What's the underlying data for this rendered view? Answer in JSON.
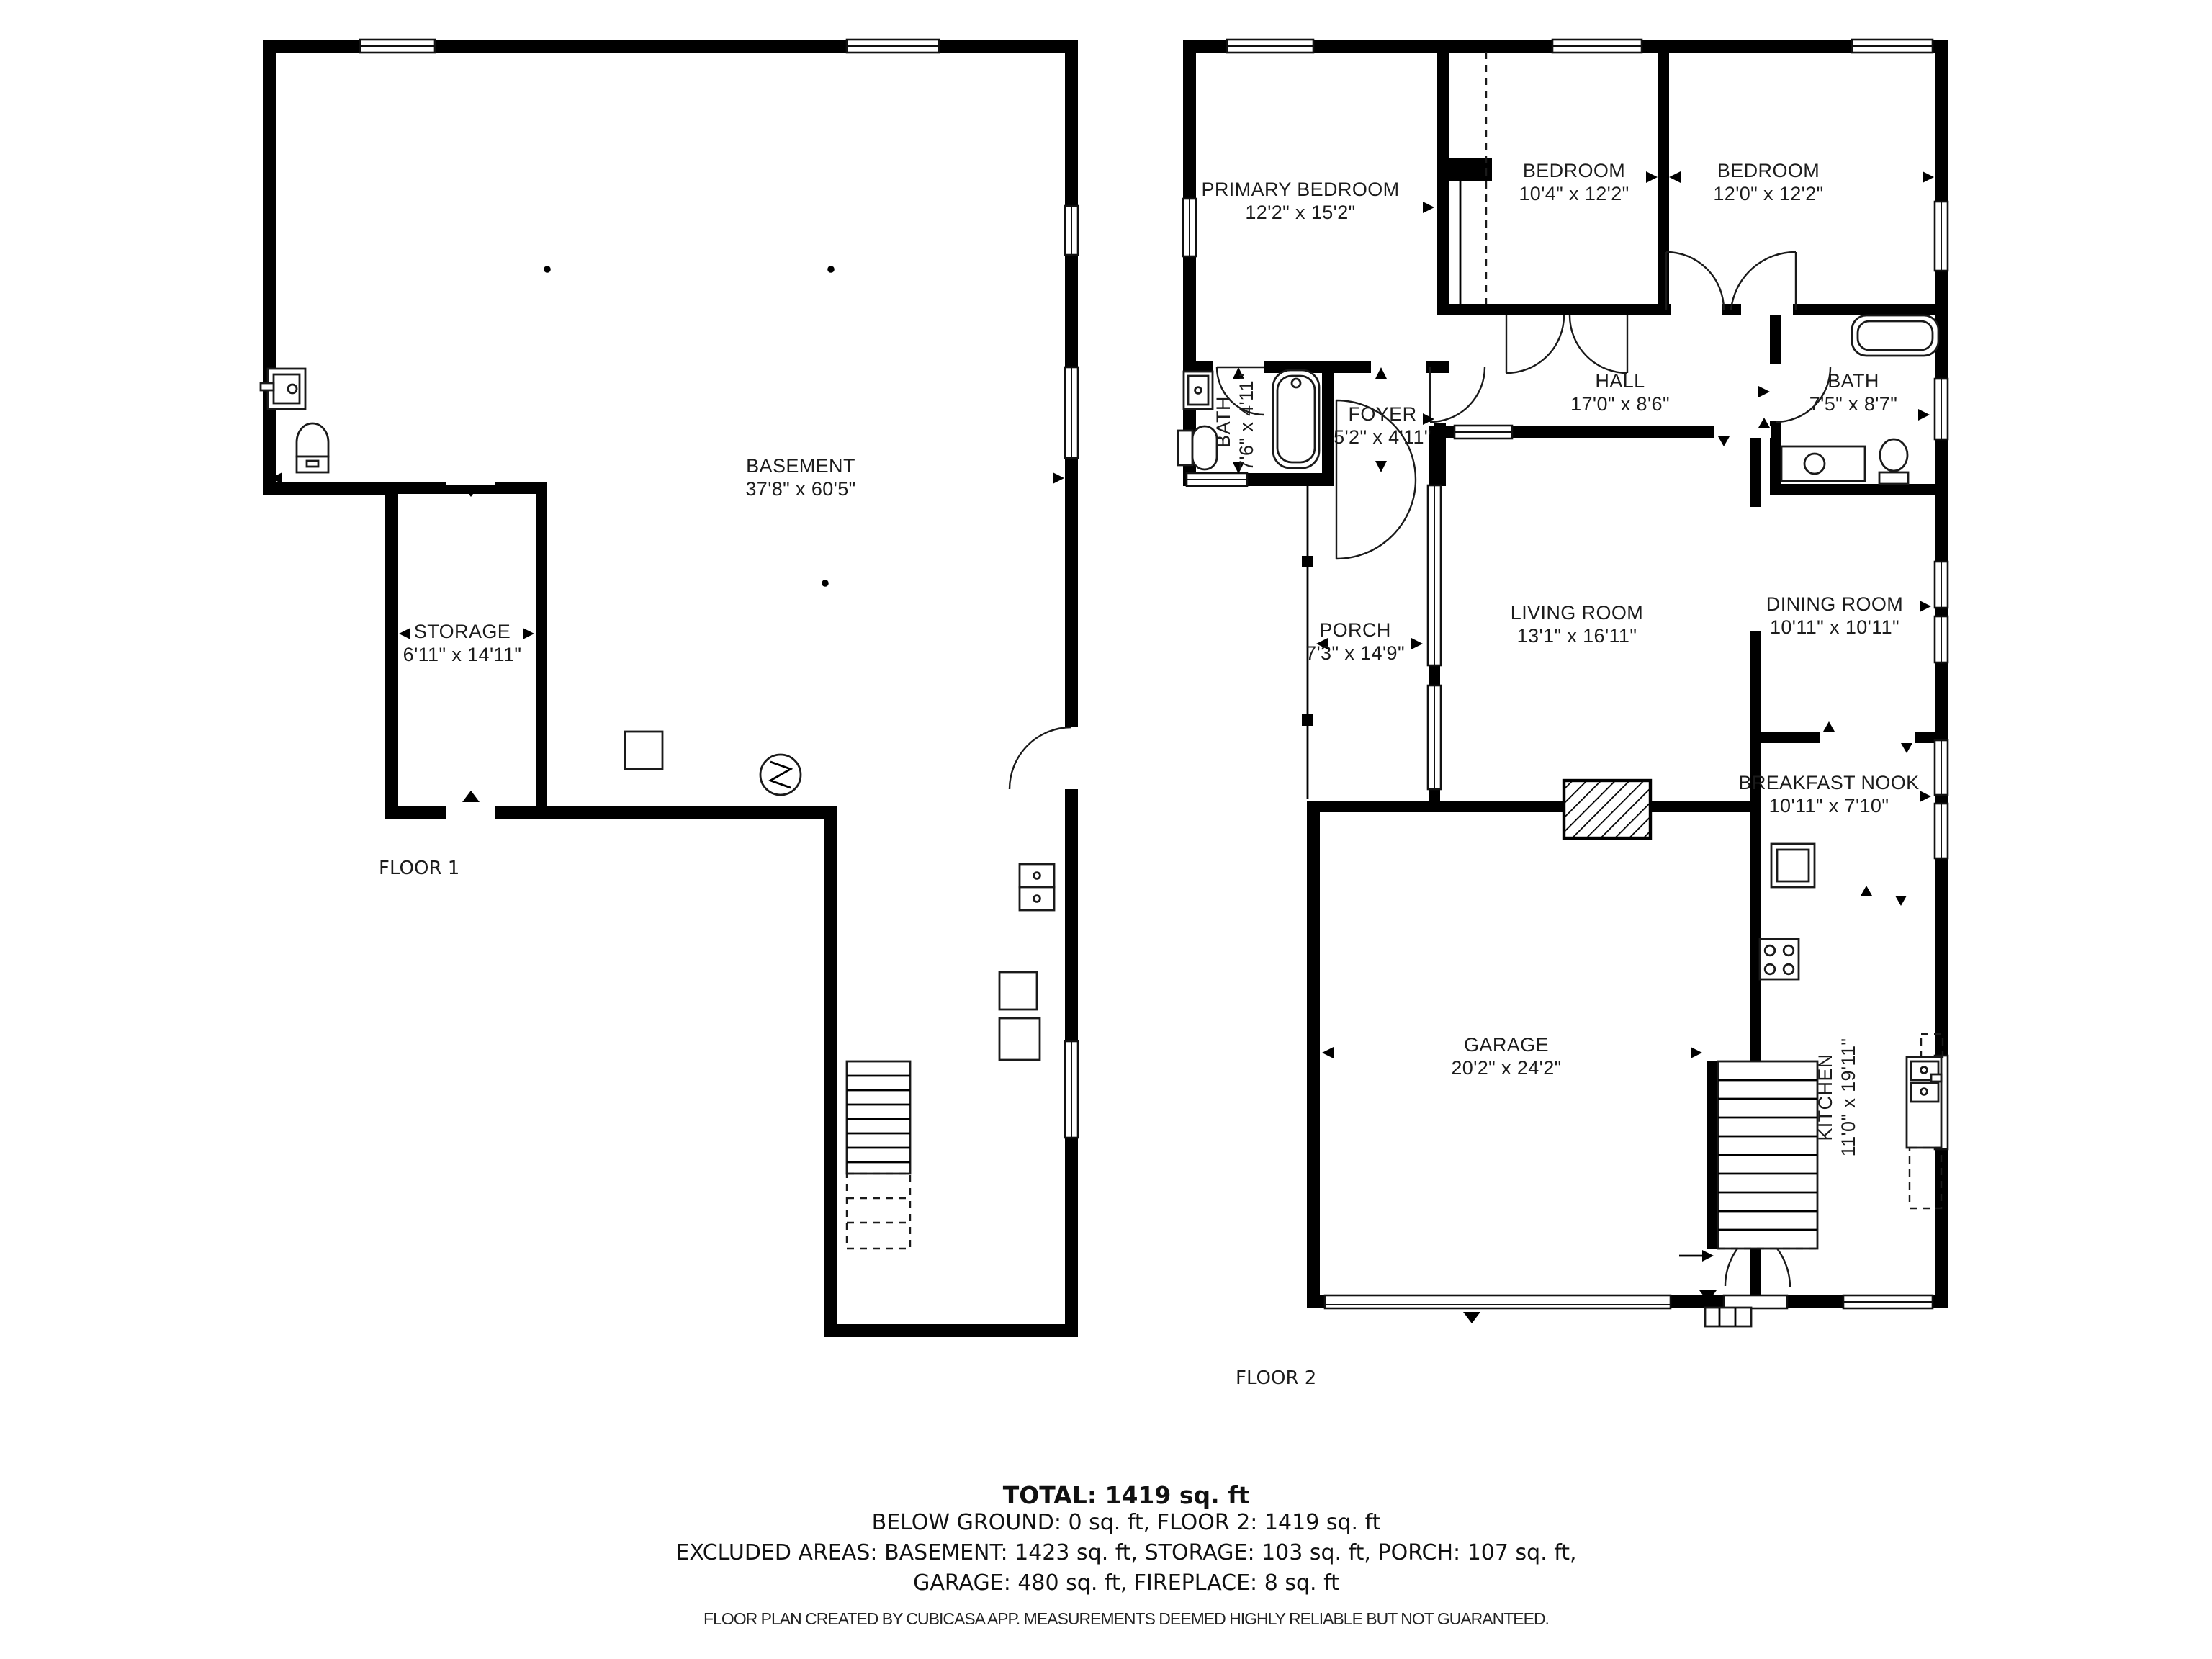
{
  "colors": {
    "wall": "#000000",
    "background": "#ffffff",
    "text": "#1c1c1c"
  },
  "floor1": {
    "label": "FLOOR 1",
    "rooms": [
      {
        "name": "BASEMENT",
        "dims": "37'8\" x 60'5\""
      },
      {
        "name": "STORAGE",
        "dims": "6'11\" x 14'11\""
      }
    ]
  },
  "floor2": {
    "label": "FLOOR 2",
    "rooms": [
      {
        "name": "PRIMARY BEDROOM",
        "dims": "12'2\" x 15'2\""
      },
      {
        "name": "BEDROOM",
        "dims": "10'4\" x 12'2\""
      },
      {
        "name": "BEDROOM",
        "dims": "12'0\" x 12'2\""
      },
      {
        "name": "HALL",
        "dims": "17'0\" x 8'6\""
      },
      {
        "name": "BATH",
        "dims": "7'6\" x 4'11\""
      },
      {
        "name": "FOYER",
        "dims": "5'2\" x 4'11\""
      },
      {
        "name": "BATH",
        "dims": "7'5\" x 8'7\""
      },
      {
        "name": "PORCH",
        "dims": "7'3\" x 14'9\""
      },
      {
        "name": "LIVING ROOM",
        "dims": "13'1\" x 16'11\""
      },
      {
        "name": "DINING ROOM",
        "dims": "10'11\" x 10'11\""
      },
      {
        "name": "BREAKFAST NOOK",
        "dims": "10'11\" x 7'10\""
      },
      {
        "name": "GARAGE",
        "dims": "20'2\" x 24'2\""
      },
      {
        "name": "KITCHEN",
        "dims": "11'0\" x 19'11\""
      }
    ]
  },
  "summary": {
    "total": "TOTAL: 1419 sq. ft",
    "line2": "BELOW GROUND: 0 sq. ft, FLOOR 2: 1419 sq. ft",
    "line3": "EXCLUDED AREAS: BASEMENT: 1423 sq. ft, STORAGE: 103 sq. ft, PORCH: 107 sq. ft,",
    "line4": "GARAGE: 480 sq. ft, FIREPLACE: 8 sq. ft"
  },
  "footer": "FLOOR PLAN CREATED BY CUBICASA APP. MEASUREMENTS DEEMED HIGHLY RELIABLE BUT NOT GUARANTEED."
}
